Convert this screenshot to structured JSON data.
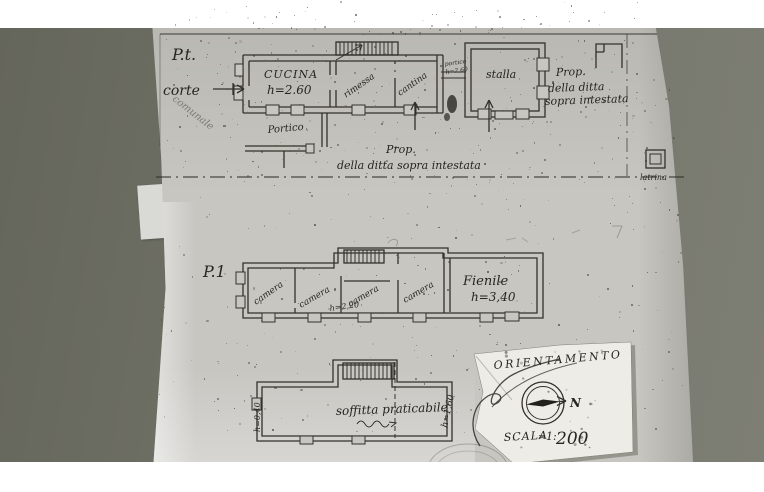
{
  "colors": {
    "ink": "#2b2a25",
    "paper": "#c7c6c1",
    "desk": "#72736a",
    "patch": "#edece7"
  },
  "sheet": {
    "ground_floor": {
      "level": "P.t.",
      "courtyard": "corte",
      "side_note": "comunale",
      "kitchen": "CUCINA",
      "kitchen_h": "h=2.60",
      "shed": "rimessa",
      "cellar": "cantina",
      "passage": "portico",
      "passage_h": "h=2,60",
      "stable": "stalla",
      "porch": "Portico",
      "latrine": "latrina",
      "prop_note_side": [
        "Prop.",
        "della ditta",
        "sopra intestata"
      ],
      "prop_note_line": [
        "Prop.",
        "della ditta sopra intestata"
      ]
    },
    "first_floor": {
      "level": "P.1",
      "room1": "camera",
      "room2": "camera",
      "room2_h": "h=2,20",
      "room3": "camera",
      "room4": "camera",
      "hayloft": "Fienile",
      "hayloft_h": "h=3,40"
    },
    "attic": {
      "label": "soffitta praticabile",
      "h_left": "h=0,40",
      "h_right": "h=1,60"
    },
    "orientation": {
      "title": "ORIENTAMENTO",
      "north": "N",
      "scale_word": "SCALA",
      "scale_eq": "=",
      "scale_ratio": "1:",
      "scale_value": "200"
    }
  }
}
